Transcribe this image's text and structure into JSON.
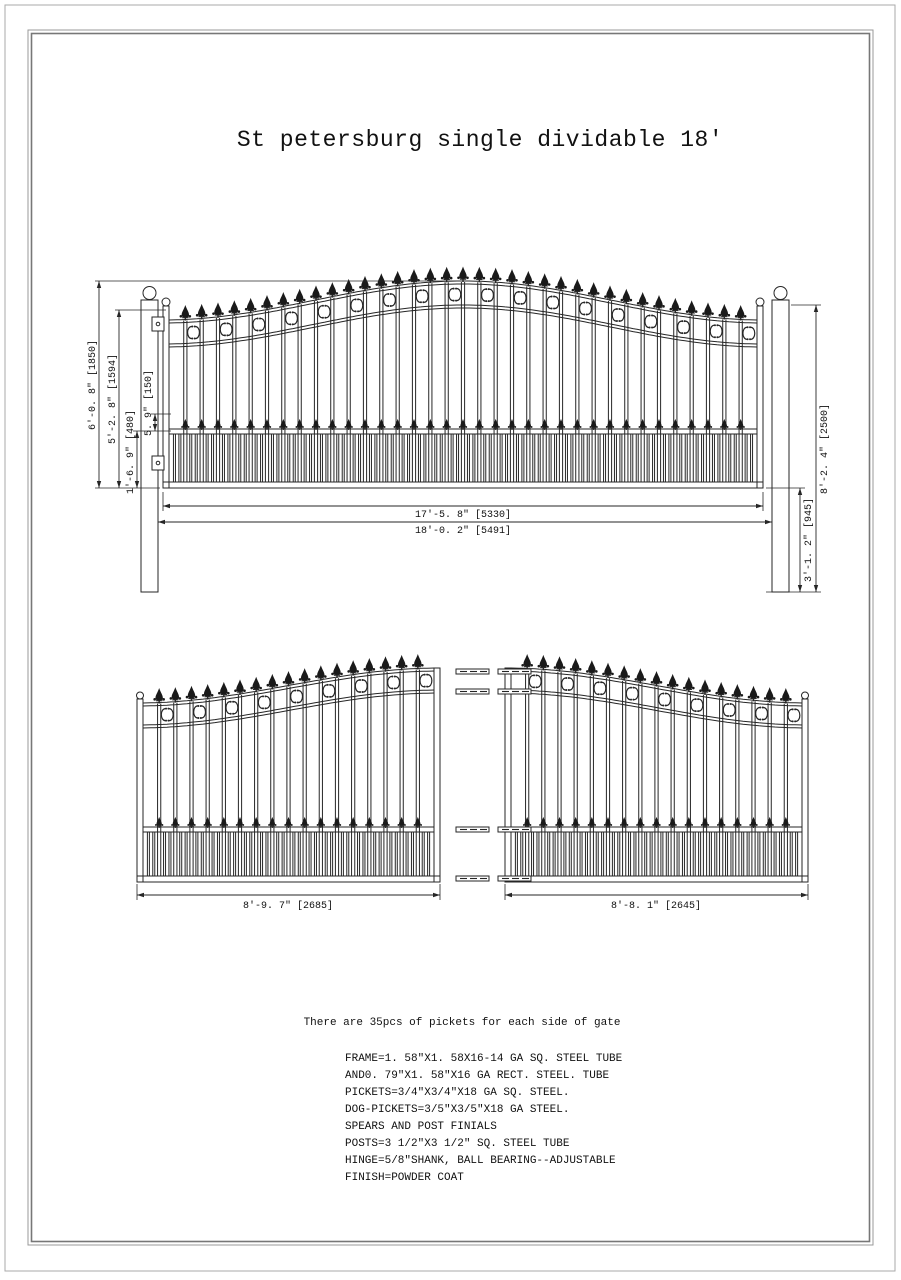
{
  "page": {
    "title": "St petersburg single dividable 18'",
    "note": "There are 35pcs of pickets for each side of gate",
    "specs": [
      "FRAME=1. 58\"X1. 58X16-14 GA SQ. STEEL TUBE",
      "AND0. 79\"X1. 58\"X16 GA RECT. STEEL. TUBE",
      "PICKETS=3/4\"X3/4\"X18 GA SQ. STEEL.",
      "DOG-PICKETS=3/5\"X3/5\"X18 GA STEEL.",
      "SPEARS AND POST FINIALS",
      "POSTS=3 1/2\"X3 1/2\" SQ. STEEL TUBE",
      "HINGE=5/8\"SHANK, BALL BEARING--ADJUSTABLE",
      "FINISH=POWDER COAT"
    ]
  },
  "dimensions": {
    "single_gate": {
      "peak_height": "6'-0. 8\" [1850]",
      "end_height": "5'-2. 8\" [1594]",
      "mid_finial_height": "5. 9\" [150]",
      "bottom_section_height": "1'-6. 9\" [480]",
      "leaf_width": "17'-5. 8\" [5330]",
      "overall_width": "18'-0. 2\" [5491]",
      "post_height": "8'-2. 4\" [2500]",
      "post_below_gate": "3'-1. 2\" [945]"
    },
    "divided_gate": {
      "left_leaf_width": "8'-9. 7\" [2685]",
      "right_leaf_width": "8'-8. 1\" [2645]"
    }
  },
  "drawing": {
    "pickets_per_side": 35,
    "dog_pickets_per_bay": 2,
    "line_color": "#262626",
    "finial_color": "#1a1a1a",
    "border_color_outer": "#aaaaaa",
    "border_color_inner": "#777777"
  }
}
